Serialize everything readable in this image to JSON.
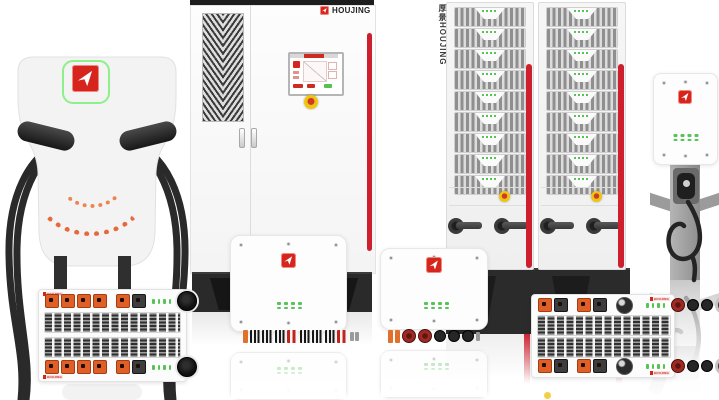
{
  "brand": {
    "name": "HOUJING",
    "vertical_name": "厚景HOUJING",
    "colors": {
      "red": "#d6251d",
      "logo_green_outline": "#8df08a",
      "led_green": "#55c455",
      "connector_orange": "#e05f27",
      "stripe_red": "#ce1f2e",
      "estop_yellow": "#f0c413",
      "cable_black": "#2a2a2a"
    }
  },
  "products": {
    "charging_pile": {
      "indicator_arc_rows": 2,
      "cable_count": 2
    },
    "power_cabinet": {
      "brand_label": "HOUJING",
      "doors": 2
    },
    "rack_towers": {
      "brand_label_vertical": "厚景HOUJING",
      "towers": 2,
      "modules_per_tower": 9,
      "breakers_per_tower": 2
    },
    "wallbox_a": {
      "led_rows": 2,
      "leds_per_row": 4,
      "connectors": [
        "orange-slim",
        "fins",
        "fins",
        "fins",
        "red-fins",
        "fins",
        "fins",
        "fins",
        "red-fins",
        "gray-slim",
        "gray-slim"
      ]
    },
    "wallbox_b": {
      "led_rows": 2,
      "leds_per_row": 4,
      "connectors": [
        "orange-slim",
        "orange-slim",
        "red-round",
        "red-round",
        "black-round",
        "black-round",
        "black-round",
        "gray-slim"
      ]
    },
    "wall_charger": {
      "led_rows": 2,
      "leds_per_row": 4
    },
    "power_module_a": {
      "brand_label": "HOUJING",
      "led_count": 4,
      "connectors": [
        "orange",
        "orange",
        "orange",
        "orange",
        "gap",
        "orange",
        "dark",
        "leds",
        "socket"
      ]
    },
    "power_module_b": {
      "brand_label": "HOUJING",
      "led_count": 4,
      "connectors": [
        "orange",
        "dark",
        "gap",
        "orange",
        "dark",
        "gap",
        "knob",
        "gap",
        "leds",
        "red-round",
        "black-round",
        "black-round",
        "ring"
      ]
    }
  }
}
